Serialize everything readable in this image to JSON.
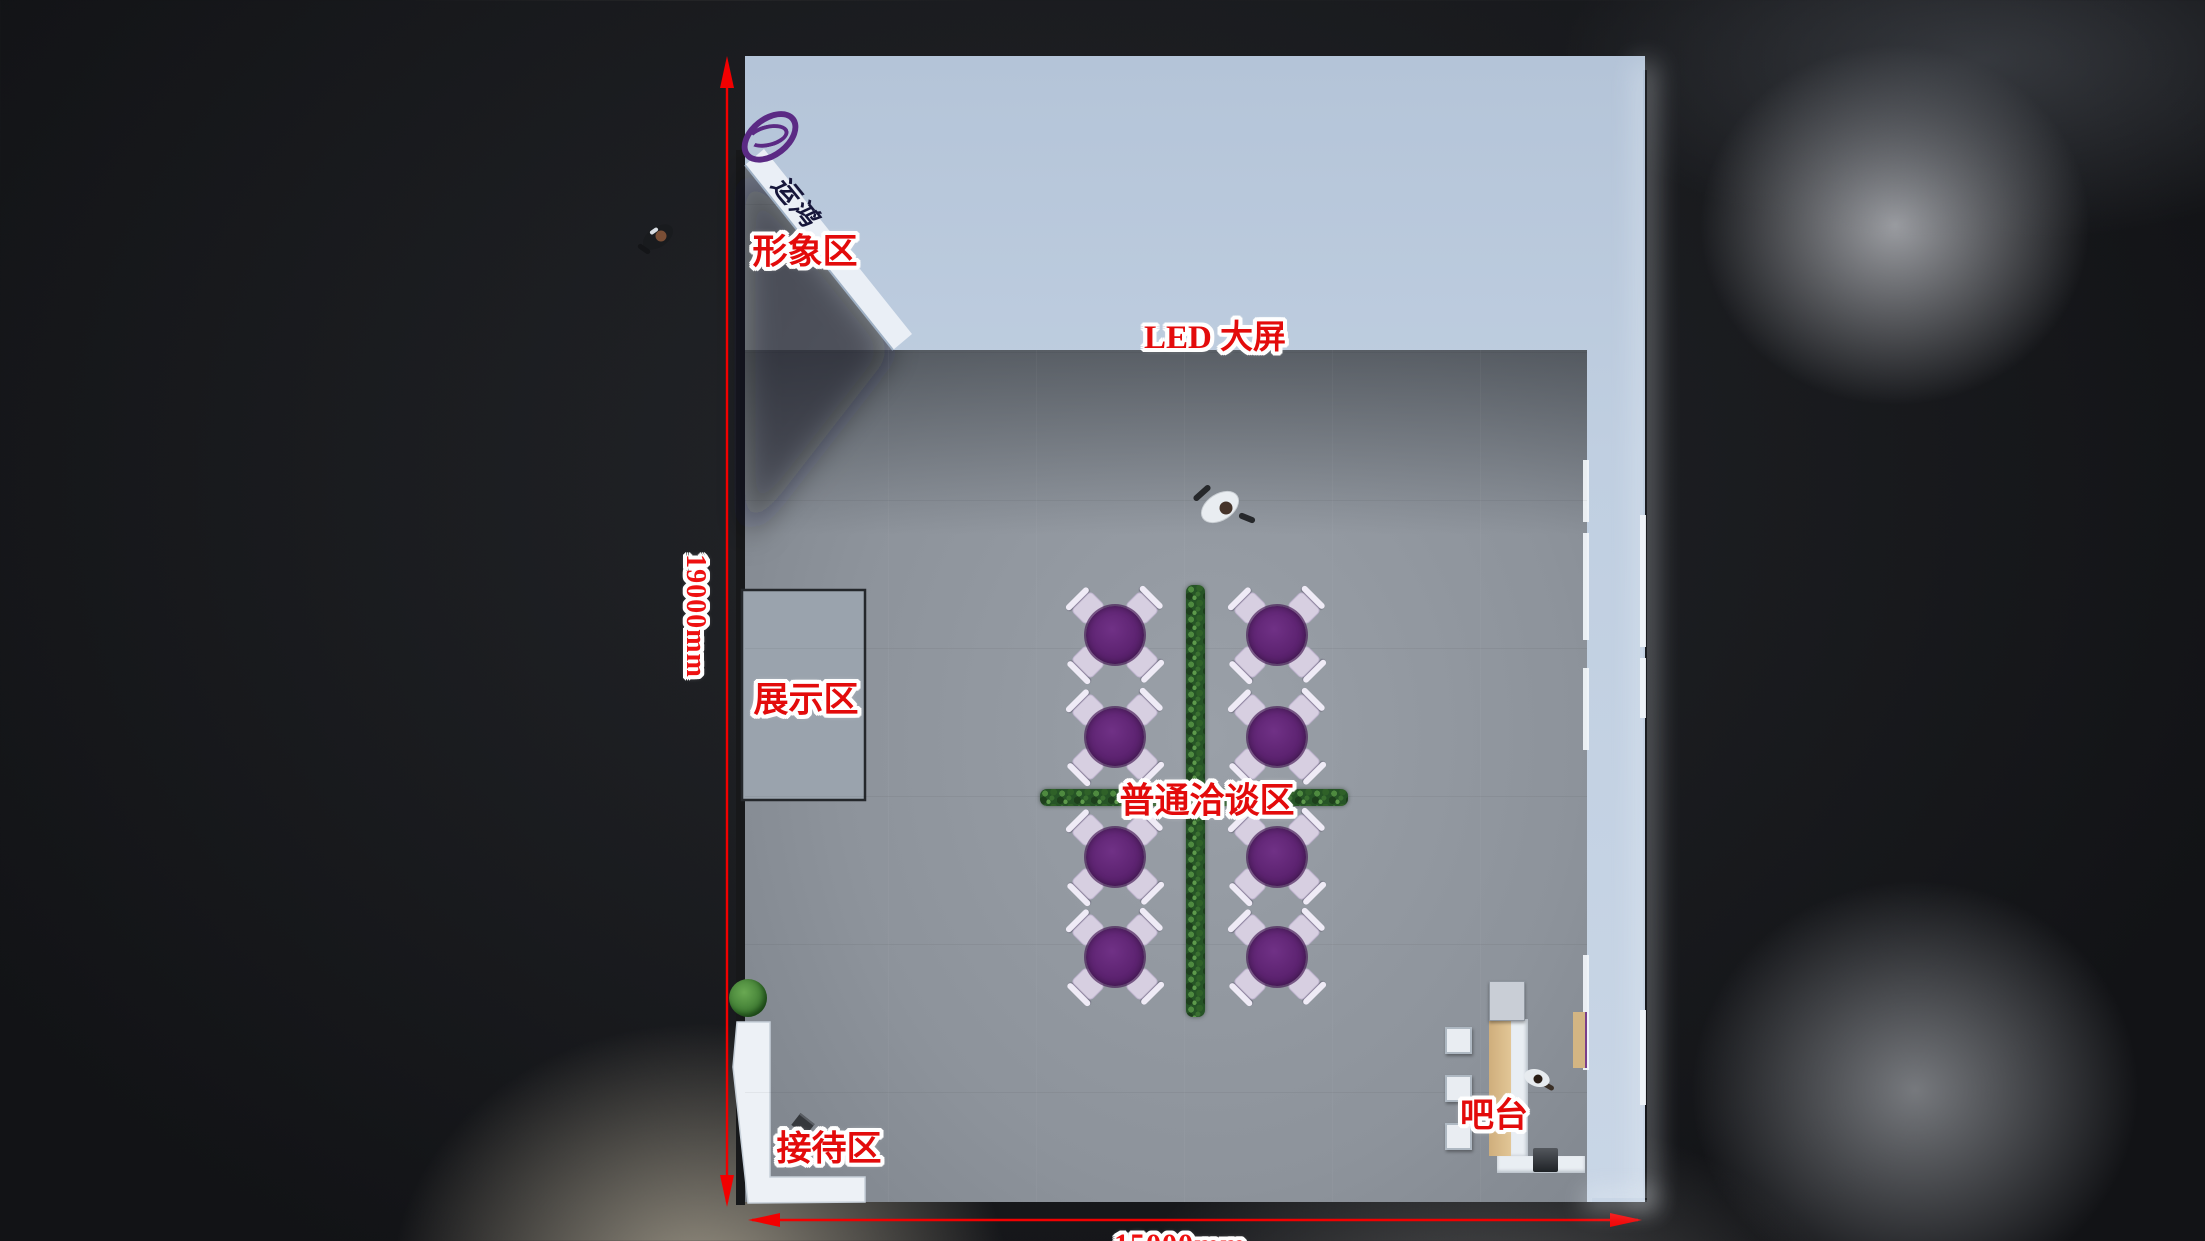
{
  "labels": {
    "image_area": "形象区",
    "led_screen": "LED 大屏",
    "display_area": "展示区",
    "negotiation_area": "普通洽谈区",
    "reception_area": "接待区",
    "bar_counter": "吧台"
  },
  "dimensions": {
    "vertical": "19000mm",
    "horizontal": "15000mm"
  },
  "brand": {
    "text": "运鸿"
  },
  "colors": {
    "dimension_red": "#f20000",
    "label_red": "#e30b0b",
    "canopy_band": "#c3d1e2",
    "floor_gray": "#8d939b",
    "table_purple": "#5d2371",
    "hedge_green": "#2c5c27",
    "counter_tan": "#d8ba8a",
    "desk_white": "#edf1f6",
    "logo_purple": "#5b2a84"
  },
  "scene": {
    "tables": {
      "columns": [
        1115,
        1277
      ],
      "rows": [
        635,
        737,
        857,
        957
      ],
      "diameter": 58,
      "chair_offset": 38,
      "chair_angles": [
        45,
        135,
        225,
        315
      ]
    },
    "bar": {
      "stools": [
        {
          "x": 1445,
          "y": 1027
        },
        {
          "x": 1445,
          "y": 1075
        },
        {
          "x": 1445,
          "y": 1123
        }
      ]
    }
  }
}
